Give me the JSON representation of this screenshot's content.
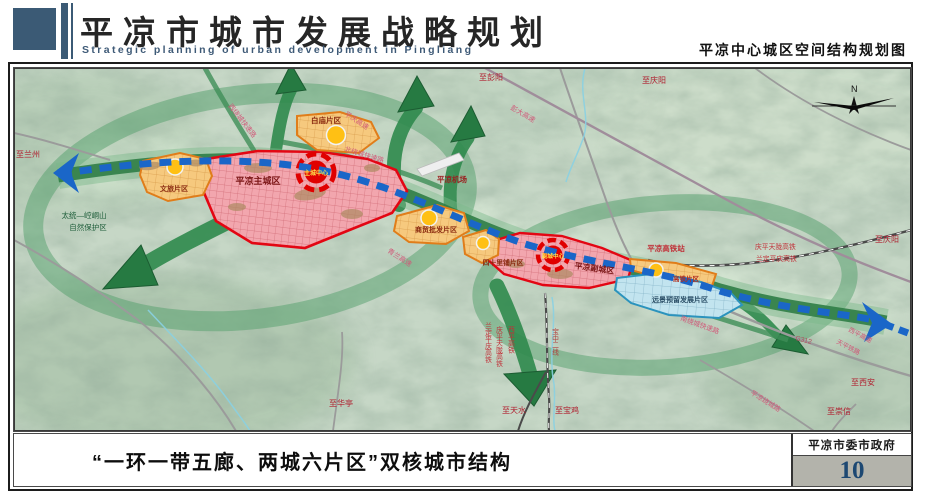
{
  "header": {
    "title": "平凉市城市发展战略规划",
    "subtitle": "Strategic planning of urban development in Pingliang",
    "map_title": "平凉中心城区空间结构规划图"
  },
  "map": {
    "compass": "N",
    "zones": {
      "main_city": "平凉主城区",
      "main_core": "主城中心",
      "sub_city": "平凉副城区",
      "sub_core": "副城中心",
      "wenlv": "文旅片区",
      "baimiao": "白庙片区",
      "shangmao": "商贸批发片区",
      "sishilipu": "四十里铺片区",
      "gaotie": "高铁片区",
      "yuanjing": "远景预留发展片区"
    },
    "roads": {
      "xiraocheng": "西绕城快速路",
      "beiraocheng": "北绕城快速路",
      "nanraocheng": "南绕城快速路",
      "pingqing": "平庆高速",
      "pengda": "彭大高速",
      "qinglan": "青兰高速",
      "g312": "G312",
      "xiping": "西平高速",
      "tianping": "天平铁路",
      "raochenglu": "平凉绕城路"
    },
    "rails": {
      "qingping_tianlong": "庆平天陇高铁",
      "landing_pingqing": "兰定平庆高铁",
      "xiping_hsr": "西平高铁",
      "baozhong": "宝中二线"
    },
    "places": {
      "airport": "平凉机场",
      "hsr_station": "平凉高铁站",
      "nature_reserve_1": "太统—崆峒山",
      "nature_reserve_2": "自然保护区"
    },
    "destinations": {
      "lanzhou": "至兰州",
      "pengyang": "至彭阳",
      "qingyang_top": "至庆阳",
      "qingyang_right": "至庆阳",
      "xian": "至西安",
      "chongxin": "至崇信",
      "huating": "至华亭",
      "tianshui": "至天水",
      "baoji": "至宝鸡"
    }
  },
  "footer": {
    "caption": "“一环一带五廊、两城六片区”双核城市结构",
    "agency": "平凉市委市政府",
    "page": "10"
  }
}
